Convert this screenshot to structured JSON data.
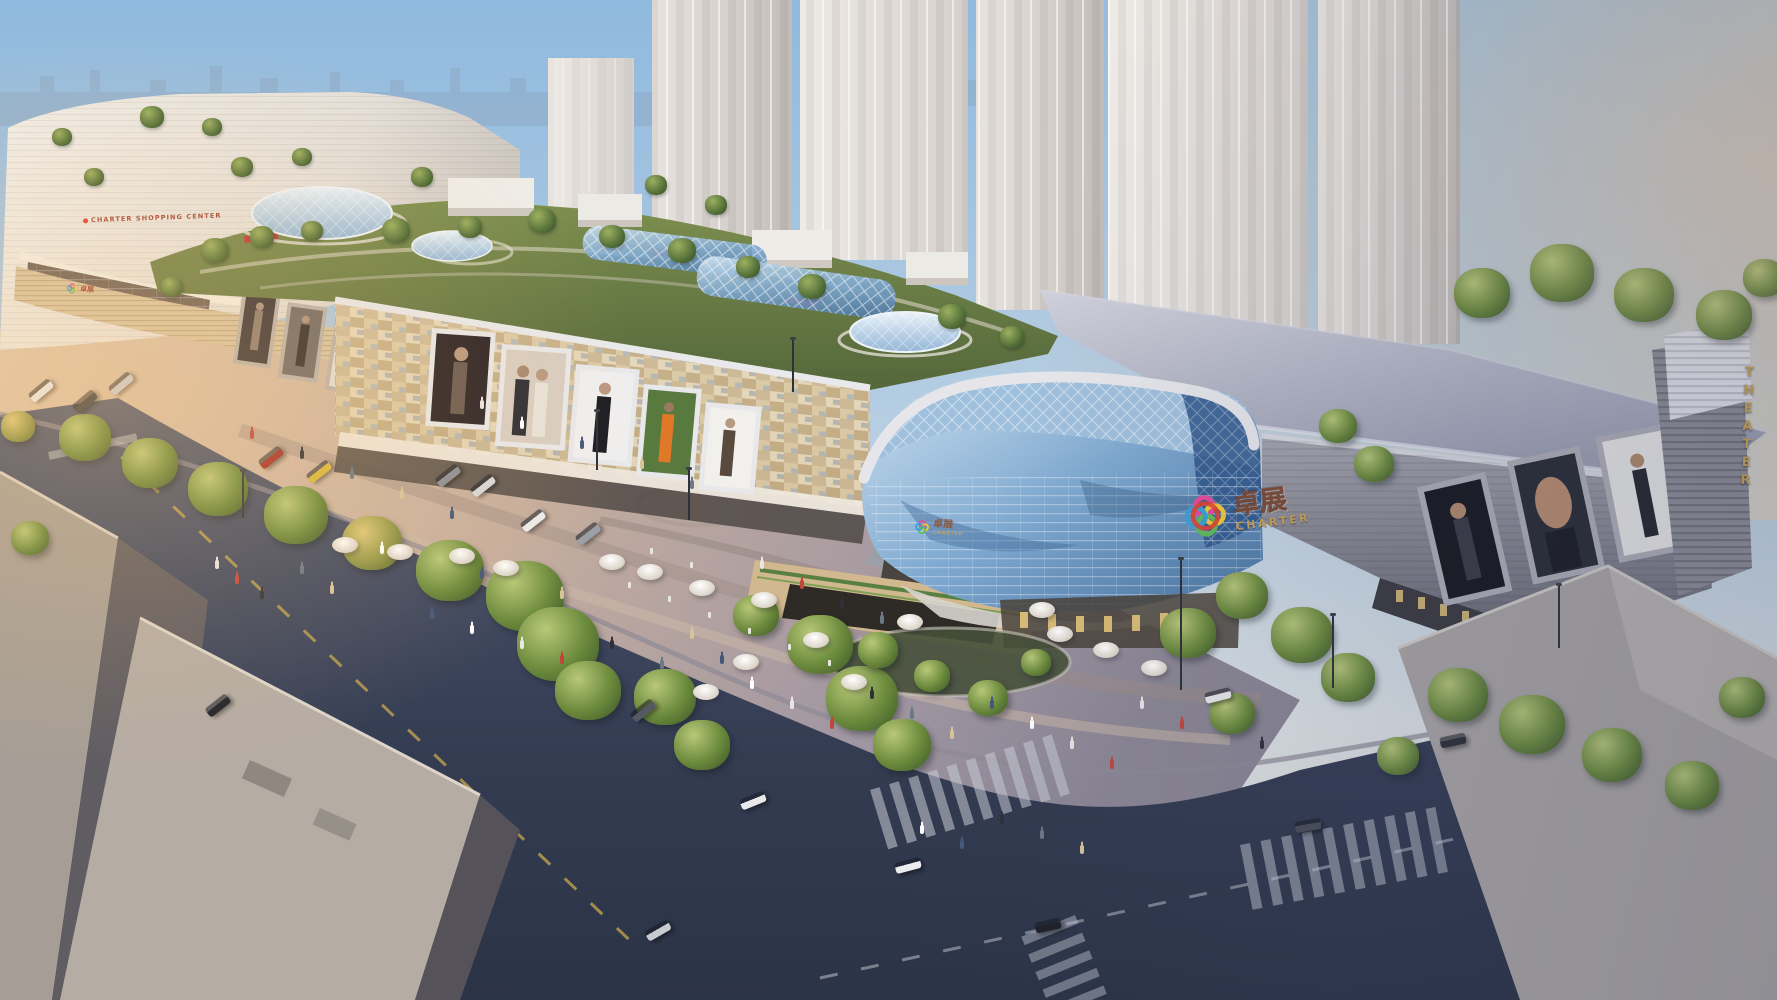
{
  "scene": {
    "signs": {
      "left_building": "CHARTER SHOPPING CENTER",
      "brand_cn": "卓展",
      "brand_en": "CHARTER",
      "theater": "THEATER",
      "theater_letters": [
        "T",
        "H",
        "E",
        "A",
        "T",
        "E",
        "R"
      ]
    },
    "colors": {
      "sky_top": "#8fb9de",
      "sky_haze": "#e8e4dd",
      "tower_grey": "#d8d3cf",
      "facade_beige": "#d3bf9d",
      "glass_blue": "#7fa9d0",
      "glass_dark": "#2a5187",
      "roof_slab": "#b9bcca",
      "roof_green": "#66793f",
      "road_asphalt": "#39415a",
      "plaza_warm": "#d3b79f",
      "plaza_cool": "#9b93a0",
      "gold": "#c9a257",
      "sign_red": "#a8473a",
      "logo_pink": "#e84a9a",
      "logo_yellow": "#f2c937",
      "logo_green": "#5fbb58",
      "logo_blue": "#3ba0d8",
      "logo_red": "#e63f2a"
    }
  }
}
